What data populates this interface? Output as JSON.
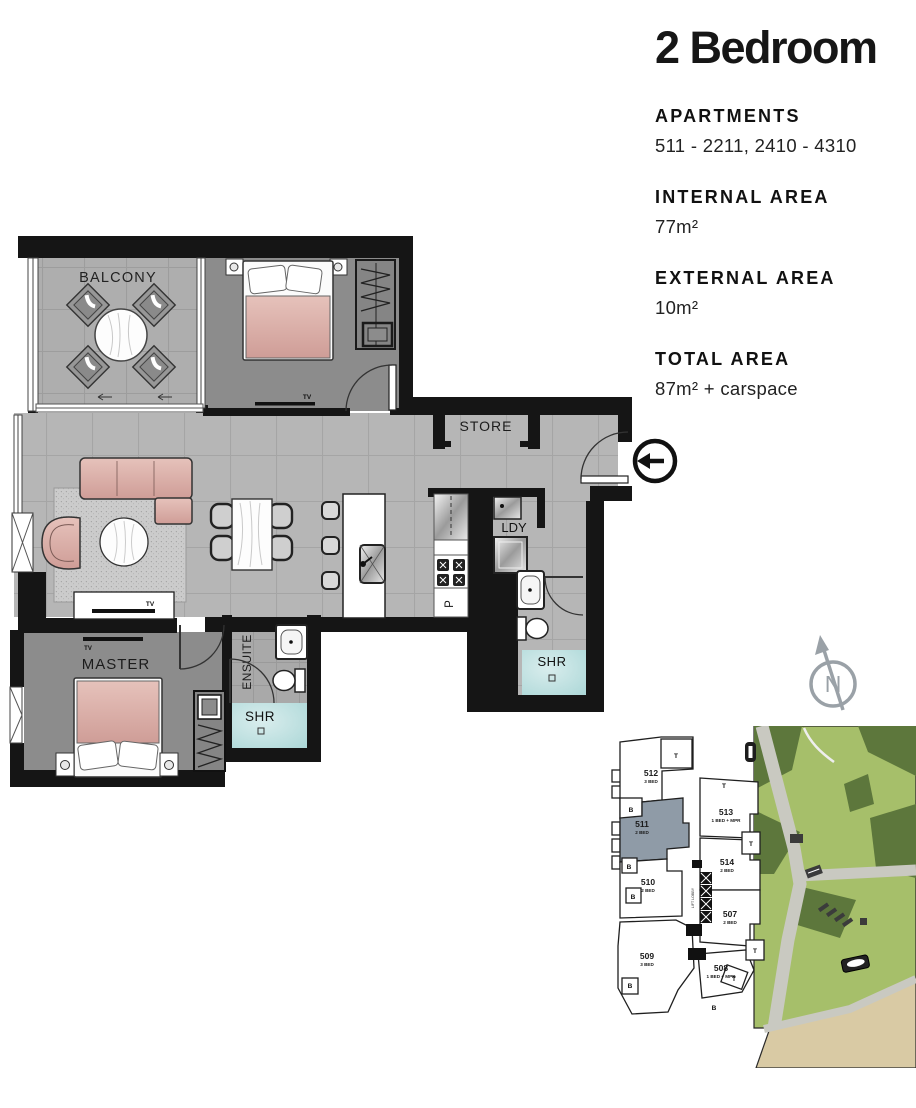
{
  "info_panel": {
    "title": "2 Bedroom",
    "sections": [
      {
        "label": "APARTMENTS",
        "value": "511 - 2211, 2410 - 4310"
      },
      {
        "label": "INTERNAL AREA",
        "value": "77m²"
      },
      {
        "label": "EXTERNAL AREA",
        "value": "10m²"
      },
      {
        "label": "TOTAL AREA",
        "value": "87m² + carspace"
      }
    ]
  },
  "floor_plan": {
    "labels": {
      "balcony": "BALCONY",
      "store": "STORE",
      "laundry": "LDY",
      "pantry": "P",
      "master": "MASTER",
      "ensuite": "ENSUITE",
      "shower_ensuite": "SHR",
      "shower_bathroom": "SHR",
      "tv": "TV"
    }
  },
  "key_plan": {
    "north_label": "N",
    "lift_label": "LIFT LOBBY",
    "balcony_marker": "B",
    "terrace_marker": "T",
    "units": [
      {
        "id": "512",
        "type": "3 BED",
        "highlighted": false
      },
      {
        "id": "511",
        "type": "2 BED",
        "highlighted": true
      },
      {
        "id": "513",
        "type": "1 BED + MPR",
        "highlighted": false
      },
      {
        "id": "514",
        "type": "2 BED",
        "highlighted": false
      },
      {
        "id": "510",
        "type": "2 BED",
        "highlighted": false
      },
      {
        "id": "507",
        "type": "2 BED",
        "highlighted": false
      },
      {
        "id": "509",
        "type": "3 BED",
        "highlighted": false
      },
      {
        "id": "508",
        "type": "1 BED + MPR",
        "highlighted": false
      }
    ]
  },
  "colors": {
    "wall_black": "#151515",
    "floor_tile": "#b6b6b6",
    "carpet": "#8c8c8c",
    "shower_floor": "#b9dede",
    "furniture_pink": "#d9aca6",
    "unit_highlight": "#8f9ba7",
    "park_light_green": "#a6bf6a",
    "park_dark_green": "#5d773c",
    "path_gray": "#c9c9c1",
    "sand": "#d9caa4",
    "compass_gray": "#9aa1a7"
  }
}
